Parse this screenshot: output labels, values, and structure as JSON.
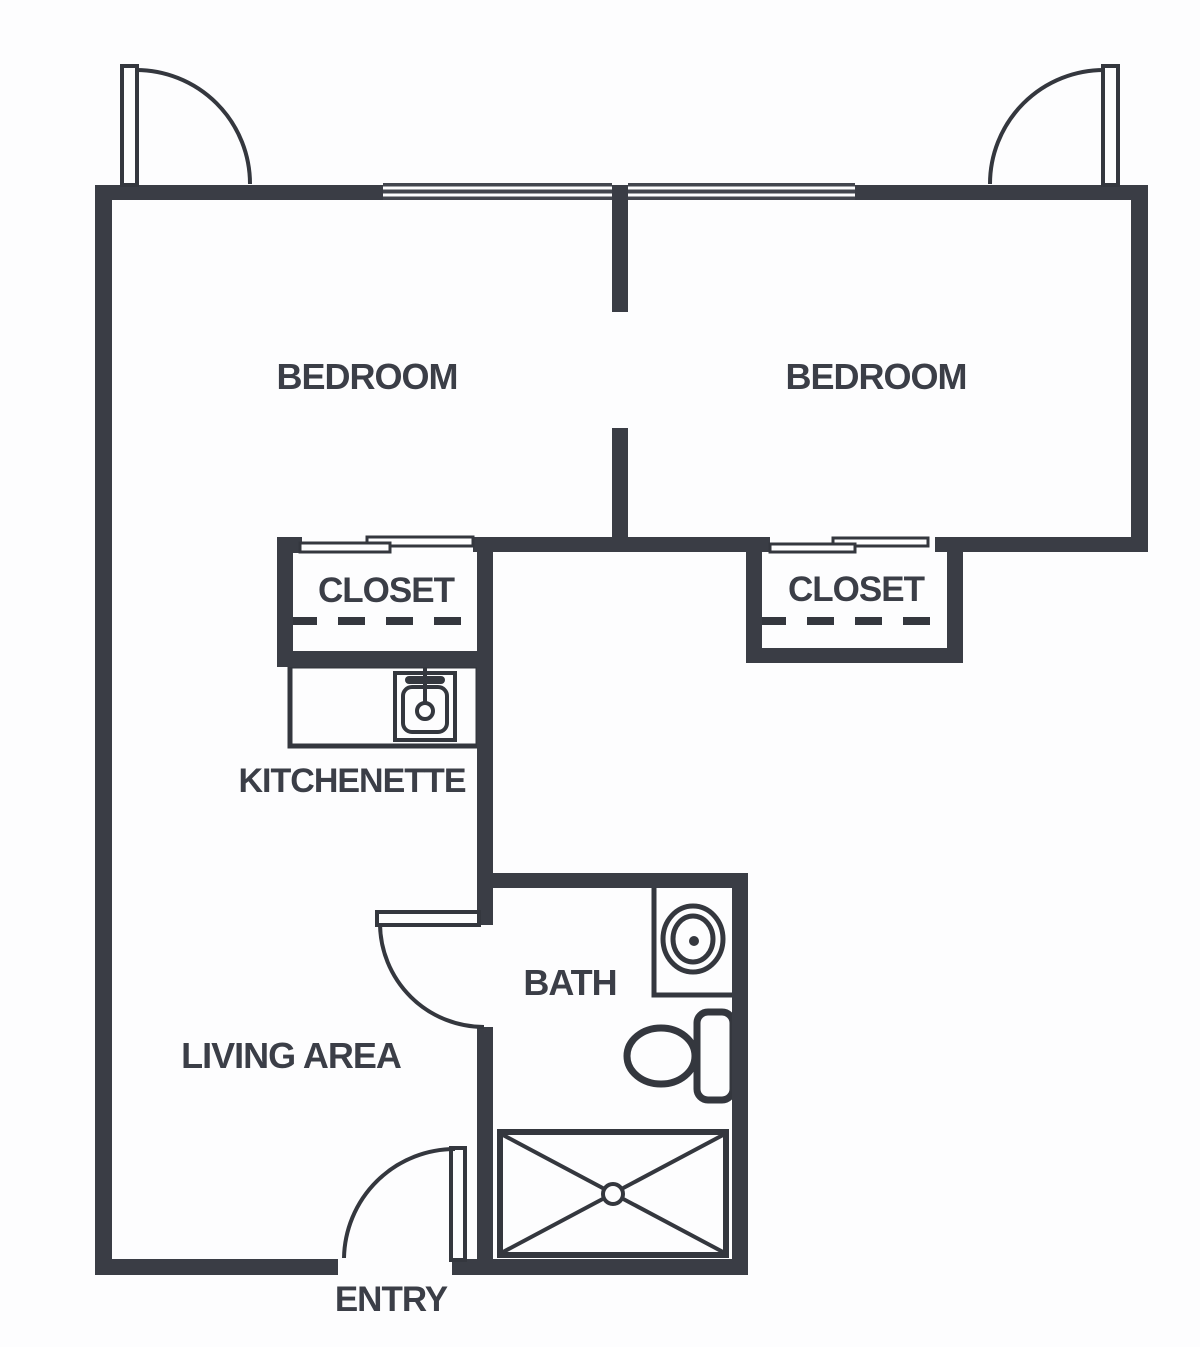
{
  "floorplan": {
    "type": "apartment-floor-plan",
    "rooms": {
      "bedroom_left": {
        "label": "BEDROOM"
      },
      "bedroom_right": {
        "label": "BEDROOM"
      },
      "closet_left": {
        "label": "CLOSET"
      },
      "closet_right": {
        "label": "CLOSET"
      },
      "kitchenette": {
        "label": "KITCHENETTE"
      },
      "bath": {
        "label": "BATH"
      },
      "living_area": {
        "label": "LIVING AREA"
      },
      "entry": {
        "label": "ENTRY"
      }
    },
    "fixtures": [
      "kitchen-sink",
      "bathroom-sink-vanity",
      "toilet",
      "shower",
      "closet-rod-left",
      "closet-rod-right"
    ],
    "doors": [
      "bedroom-left-entry-door",
      "bedroom-right-entry-door",
      "bath-door",
      "main-entry-door",
      "closet-left-sliding-doors",
      "closet-right-sliding-doors"
    ],
    "windows": [
      "top-wall-window-left",
      "top-wall-window-right"
    ],
    "colors": {
      "wall": "#3a3d45",
      "line": "#34373e",
      "background": "#fdfdfe",
      "text": "#3b3e47"
    }
  }
}
